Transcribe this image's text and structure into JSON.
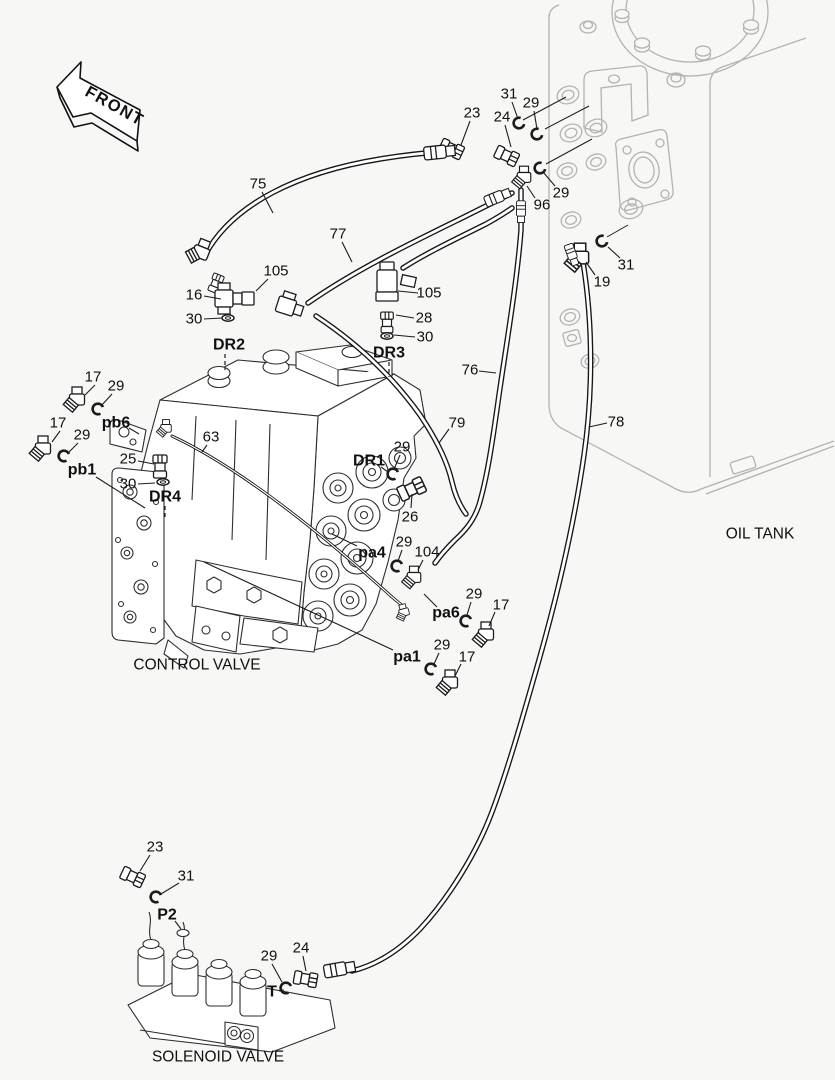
{
  "doc_type": "hydraulic piping parts diagram",
  "colors": {
    "background": "#f7f7f6",
    "dark_line": "#1c1c1c",
    "tank_line": "#b3b3b3",
    "text": "#111111"
  },
  "front_arrow": {
    "label": "FRONT"
  },
  "captions": [
    {
      "id": "control-valve-caption",
      "text": "CONTROL VALVE",
      "x": 197,
      "y": 665
    },
    {
      "id": "oil-tank-caption",
      "text": "OIL TANK",
      "x": 760,
      "y": 534
    },
    {
      "id": "solenoid-valve-caption",
      "text": "SOLENOID VALVE",
      "x": 218,
      "y": 1057
    }
  ],
  "callouts": [
    {
      "text": "75",
      "x": 258,
      "y": 184,
      "bold": false,
      "leader": [
        262,
        192,
        273,
        213
      ]
    },
    {
      "text": "77",
      "x": 338,
      "y": 234,
      "bold": false,
      "leader": [
        342,
        242,
        352,
        262
      ]
    },
    {
      "text": "105",
      "x": 276,
      "y": 271,
      "bold": false,
      "leader": [
        268,
        279,
        256,
        291
      ]
    },
    {
      "text": "16",
      "x": 194,
      "y": 295,
      "bold": false,
      "leader": [
        204,
        296,
        221,
        299
      ]
    },
    {
      "text": "30",
      "x": 194,
      "y": 319,
      "bold": false,
      "leader": [
        204,
        319,
        222,
        318
      ]
    },
    {
      "text": "DR2",
      "x": 229,
      "y": 345,
      "bold": true
    },
    {
      "text": "105",
      "x": 429,
      "y": 293,
      "bold": false,
      "leader": [
        418,
        293,
        398,
        291
      ]
    },
    {
      "text": "28",
      "x": 424,
      "y": 318,
      "bold": false,
      "leader": [
        414,
        318,
        396,
        315
      ]
    },
    {
      "text": "30",
      "x": 425,
      "y": 337,
      "bold": false,
      "leader": [
        415,
        337,
        394,
        335
      ]
    },
    {
      "text": "DR3",
      "x": 389,
      "y": 353,
      "bold": true
    },
    {
      "text": "23",
      "x": 472,
      "y": 113,
      "bold": false,
      "leader": [
        470,
        121,
        461,
        145
      ]
    },
    {
      "text": "24",
      "x": 502,
      "y": 117,
      "bold": false,
      "leader": [
        505,
        125,
        511,
        147
      ]
    },
    {
      "text": "31",
      "x": 509,
      "y": 94,
      "bold": false,
      "leader": [
        512,
        102,
        518,
        119
      ]
    },
    {
      "text": "29",
      "x": 531,
      "y": 103,
      "bold": false,
      "leader": [
        534,
        111,
        537,
        129
      ]
    },
    {
      "text": "29",
      "x": 561,
      "y": 193,
      "bold": false,
      "leader": [
        555,
        186,
        543,
        172
      ]
    },
    {
      "text": "96",
      "x": 542,
      "y": 205,
      "bold": false,
      "leader": [
        535,
        198,
        527,
        186
      ]
    },
    {
      "text": "31",
      "x": 626,
      "y": 265,
      "bold": false,
      "leader": [
        620,
        258,
        608,
        247
      ]
    },
    {
      "text": "19",
      "x": 602,
      "y": 282,
      "bold": false,
      "leader": [
        595,
        275,
        586,
        262
      ]
    },
    {
      "text": "76",
      "x": 470,
      "y": 370,
      "bold": false,
      "leader": [
        479,
        371,
        496,
        373
      ]
    },
    {
      "text": "78",
      "x": 616,
      "y": 422,
      "bold": false,
      "leader": [
        607,
        423,
        589,
        427
      ]
    },
    {
      "text": "79",
      "x": 457,
      "y": 423,
      "bold": false,
      "leader": [
        449,
        429,
        439,
        443
      ]
    },
    {
      "text": "29",
      "x": 402,
      "y": 447,
      "bold": false,
      "leader": [
        400,
        455,
        395,
        467
      ]
    },
    {
      "text": "DR1",
      "x": 369,
      "y": 461,
      "bold": true,
      "leader": [
        381,
        467,
        388,
        472
      ]
    },
    {
      "text": "26",
      "x": 410,
      "y": 517,
      "bold": false,
      "leader": [
        411,
        508,
        412,
        494
      ]
    },
    {
      "text": "pa4",
      "x": 372,
      "y": 553,
      "bold": true,
      "leader": [
        357,
        546,
        332,
        534
      ]
    },
    {
      "text": "29",
      "x": 404,
      "y": 542,
      "bold": false,
      "leader": [
        402,
        550,
        398,
        561
      ]
    },
    {
      "text": "104",
      "x": 427,
      "y": 552,
      "bold": false,
      "leader": [
        423,
        560,
        418,
        570
      ]
    },
    {
      "text": "pa6",
      "x": 446,
      "y": 613,
      "bold": true,
      "leader": [
        437,
        607,
        424,
        594
      ]
    },
    {
      "text": "29",
      "x": 474,
      "y": 594,
      "bold": false,
      "leader": [
        471,
        602,
        467,
        615
      ]
    },
    {
      "text": "17",
      "x": 501,
      "y": 605,
      "bold": false,
      "leader": [
        495,
        612,
        489,
        626
      ]
    },
    {
      "text": "pa1",
      "x": 407,
      "y": 657,
      "bold": true,
      "leader": [
        393,
        650,
        204,
        562
      ]
    },
    {
      "text": "29",
      "x": 442,
      "y": 645,
      "bold": false,
      "leader": [
        439,
        653,
        434,
        664
      ]
    },
    {
      "text": "17",
      "x": 467,
      "y": 657,
      "bold": false,
      "leader": [
        461,
        664,
        455,
        676
      ]
    },
    {
      "text": "17",
      "x": 93,
      "y": 377,
      "bold": false,
      "leader": [
        95,
        385,
        85,
        395
      ]
    },
    {
      "text": "29",
      "x": 116,
      "y": 386,
      "bold": false,
      "leader": [
        112,
        394,
        101,
        406
      ]
    },
    {
      "text": "pb6",
      "x": 116,
      "y": 423,
      "bold": true,
      "leader": [
        129,
        428,
        139,
        434
      ]
    },
    {
      "text": "17",
      "x": 58,
      "y": 423,
      "bold": false,
      "leader": [
        60,
        431,
        52,
        442
      ]
    },
    {
      "text": "29",
      "x": 82,
      "y": 435,
      "bold": false,
      "leader": [
        78,
        443,
        68,
        453
      ]
    },
    {
      "text": "pb1",
      "x": 82,
      "y": 470,
      "bold": true,
      "leader": [
        96,
        477,
        145,
        508
      ]
    },
    {
      "text": "25",
      "x": 128,
      "y": 459,
      "bold": false,
      "leader": [
        138,
        461,
        154,
        464
      ]
    },
    {
      "text": "30",
      "x": 128,
      "y": 484,
      "bold": false,
      "leader": [
        138,
        484,
        155,
        483
      ]
    },
    {
      "text": "DR4",
      "x": 165,
      "y": 497,
      "bold": true
    },
    {
      "text": "63",
      "x": 211,
      "y": 437,
      "bold": false,
      "leader": [
        207,
        445,
        202,
        452
      ]
    },
    {
      "text": "23",
      "x": 155,
      "y": 847,
      "bold": false,
      "leader": [
        150,
        855,
        140,
        871
      ]
    },
    {
      "text": "31",
      "x": 186,
      "y": 876,
      "bold": false,
      "leader": [
        179,
        883,
        161,
        894
      ]
    },
    {
      "text": "P2",
      "x": 167,
      "y": 915,
      "bold": true,
      "leader": [
        175,
        921,
        181,
        929
      ]
    },
    {
      "text": "29",
      "x": 269,
      "y": 956,
      "bold": false,
      "leader": [
        272,
        964,
        282,
        982
      ]
    },
    {
      "text": "24",
      "x": 301,
      "y": 948,
      "bold": false,
      "leader": [
        303,
        956,
        306,
        971
      ]
    },
    {
      "text": "T",
      "x": 272,
      "y": 992,
      "bold": true,
      "leader": [
        279,
        991,
        284,
        990
      ]
    }
  ],
  "dashed_leaders": [
    {
      "x1": 225,
      "y1": 354,
      "x2": 225,
      "y2": 370
    },
    {
      "x1": 389,
      "y1": 362,
      "x2": 389,
      "y2": 377
    },
    {
      "x1": 165,
      "y1": 506,
      "x2": 165,
      "y2": 519
    }
  ]
}
